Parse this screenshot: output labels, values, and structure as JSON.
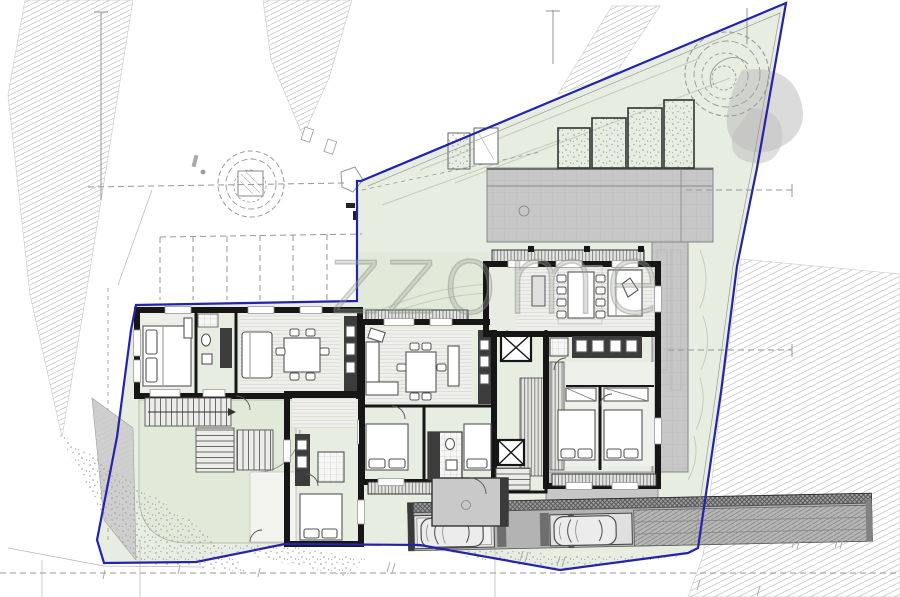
{
  "watermark": {
    "text": "zzome"
  },
  "colors": {
    "boundary": "#2424aa",
    "site_green": "#e7ede1",
    "courtyard": "#e1ead9",
    "terrace": "#c7c7c7",
    "wall": "#161616",
    "dark_fixture": "#3c3c3c",
    "hatch": "#c6c6c6",
    "floor": "#f1f1ee",
    "tree": "#9a9a9a",
    "shadow": "#bdbdbd",
    "car_body": "#ececec"
  },
  "scene": {
    "type": "architectural-site-plan-floor-plan",
    "buildings": [
      "left-building",
      "middle-building",
      "right-building"
    ],
    "trees_visible": 2,
    "cars_in_parking": 2,
    "street_parking_bays": 6,
    "elevators": 2
  }
}
